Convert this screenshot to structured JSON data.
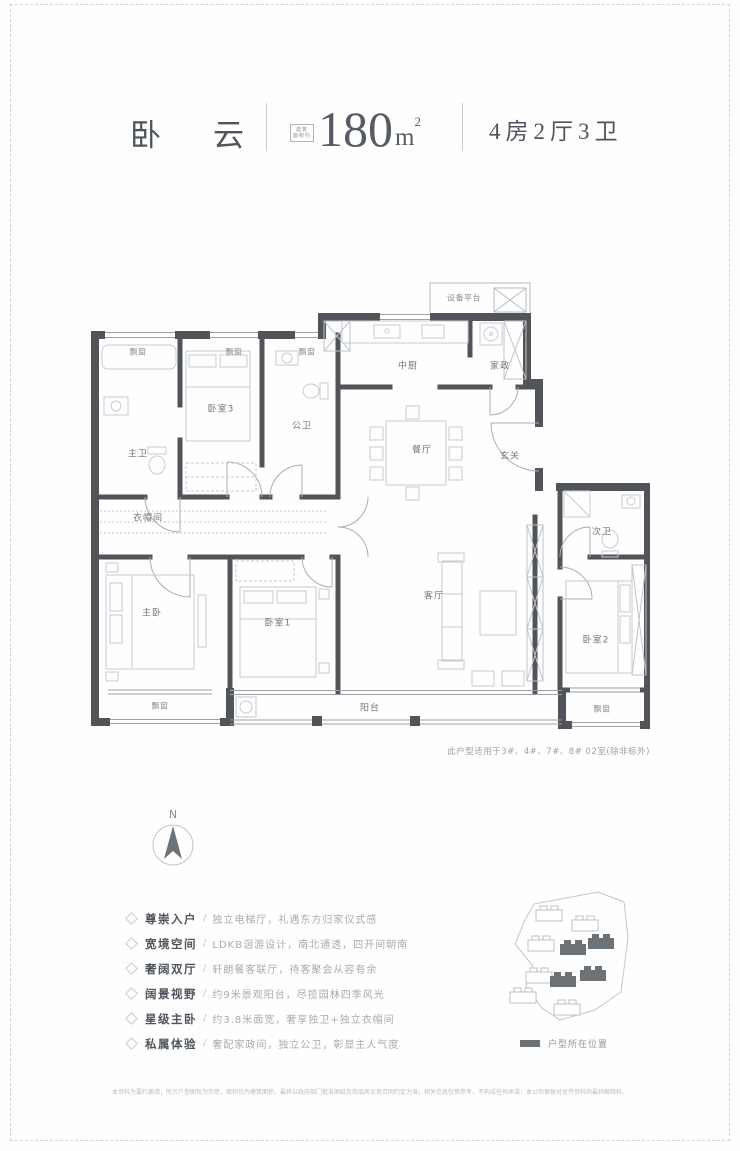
{
  "header": {
    "title": "卧云",
    "area_label_line1": "建筑",
    "area_label_line2": "面积约",
    "area_value": "180",
    "area_unit": "m",
    "area_unit_sup": "2",
    "spec": "4房2厅3卫"
  },
  "plan": {
    "labels": {
      "equipment_platform": "设备平台",
      "kitchen": "中厨",
      "housekeeping": "家政",
      "dining": "餐厅",
      "foyer": "玄关",
      "bedroom3": "卧室3",
      "public_bath": "公卫",
      "master_bath": "主卫",
      "cloakroom": "衣帽间",
      "master_bedroom": "主卧",
      "bedroom1": "卧室1",
      "living_room": "客厅",
      "second_bath": "次卫",
      "bedroom2": "卧室2",
      "balcony": "阳台",
      "bay_window": "飘窗"
    },
    "note": "此户型适用于3#、4#、7#、8# 02室(除非标外)"
  },
  "compass": {
    "north": "N"
  },
  "features": {
    "separator": "/",
    "items": [
      {
        "title": "尊崇入户",
        "desc": "独立电梯厅，礼遇东方归家仪式感"
      },
      {
        "title": "宽境空间",
        "desc": "LDKB洄游设计，南北通透，四开间朝南"
      },
      {
        "title": "奢阔双厅",
        "desc": "轩朗餐客联厅，待客聚会从容有余"
      },
      {
        "title": "阔景视野",
        "desc": "约9米景观阳台，尽揽园林四季风光"
      },
      {
        "title": "星级主卧",
        "desc": "约3.8米面宽，奢享独卫+独立衣帽间"
      },
      {
        "title": "私属体验",
        "desc": "奢配家政间，独立公卫，彰显主人气度"
      }
    ]
  },
  "siteplan": {
    "legend": "户型所在位置"
  },
  "footer": {
    "disclaimer": "本资料为要约邀请，所示户型图仅为示意，面积均为建筑面积，最终以政府部门批准图纸及商品房买卖合同约定为准；相关信息仅供参考，不构成任何承诺；本公司保留对宣传资料的最终解释权。"
  }
}
